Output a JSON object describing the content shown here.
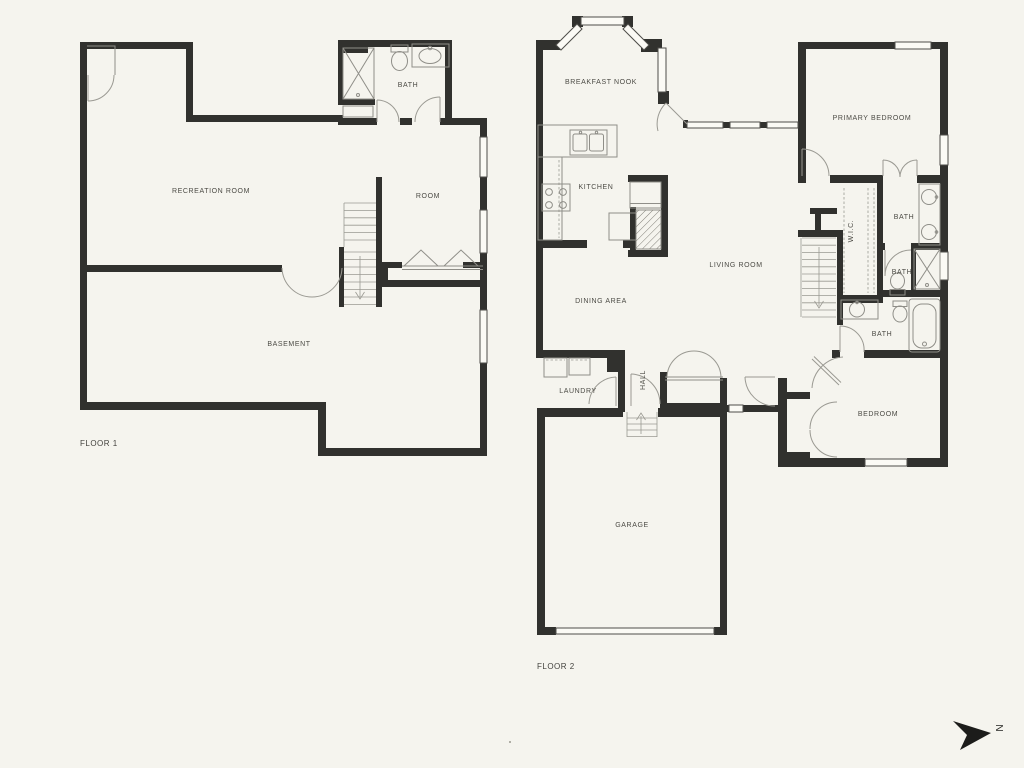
{
  "colors": {
    "background": "#f5f4ee",
    "wall": "#31312e",
    "fixture_line": "#8f8e88",
    "label_text": "#4c4b45"
  },
  "floor1": {
    "name": "FLOOR 1",
    "rooms": {
      "recreation": "RECREATION ROOM",
      "room": "ROOM",
      "basement": "BASEMENT",
      "bath": "BATH"
    }
  },
  "floor2": {
    "name": "FLOOR 2",
    "rooms": {
      "breakfast_nook": "BREAKFAST NOOK",
      "kitchen": "KITCHEN",
      "living": "LIVING ROOM",
      "dining": "DINING AREA",
      "primary_bedroom": "PRIMARY BEDROOM",
      "bath_primary": "BATH",
      "wic": "W.I.C.",
      "bath_mid": "BATH",
      "bath_lower": "BATH",
      "laundry": "LAUNDRY",
      "hall": "HALL",
      "bedroom": "BEDROOM",
      "garage": "GARAGE"
    }
  },
  "compass": {
    "north": "N"
  }
}
